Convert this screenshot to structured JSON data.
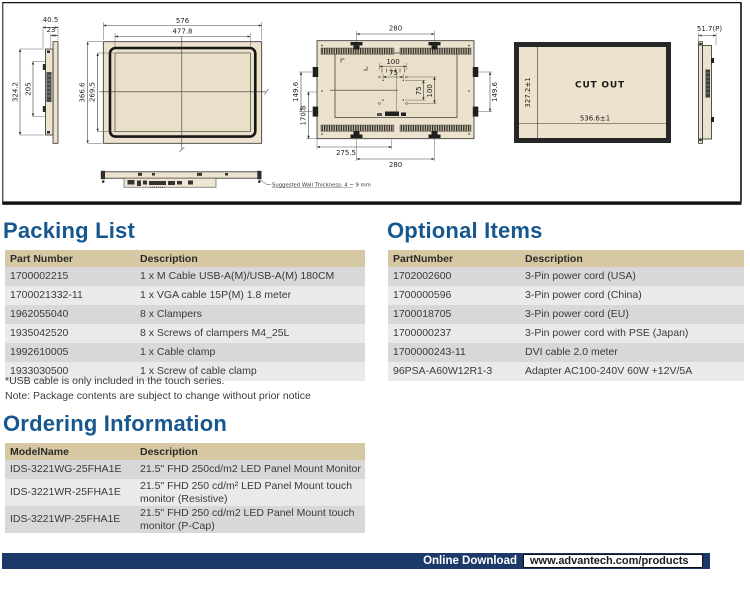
{
  "colors": {
    "heading_blue": "#17578f",
    "table_header_bg": "#d6c8a2",
    "row_dark": "#d8d8d8",
    "row_light": "#eaeaea",
    "footer_bar_navy": "#1b3a69",
    "drawing_fill_tan": "#ece2cd"
  },
  "drawings": {
    "side_left": {
      "depth": "40.5",
      "depth_inner": "23",
      "height": "324.2",
      "height_inner": "205"
    },
    "front": {
      "width": "576",
      "width_inner": "477.8",
      "height": "366.6",
      "height_inner": "269.5"
    },
    "bottom": {
      "note": "Suggested Wall Thickness: 4 ~ 9 mm"
    },
    "back": {
      "width_top": "280",
      "vesa_h100": "100",
      "vesa_h75": "75",
      "vesa_v75": "75",
      "vesa_v100": "100",
      "clamp_left": "149.6",
      "clamp_right": "149.6",
      "height_bottom_left": "170.8",
      "width_bottom_inner": "275.5",
      "width_bottom": "280"
    },
    "cutout": {
      "label": "CUT OUT",
      "width": "536.6±1",
      "height": "327.2±1"
    },
    "side_right": {
      "depth": "51.7(P)"
    }
  },
  "packing_list": {
    "title": "Packing List",
    "columns": [
      "Part Number",
      "Description"
    ],
    "rows": [
      {
        "part": "1700002215",
        "desc": "1 x M Cable USB-A(M)/USB-A(M) 180CM"
      },
      {
        "part": "1700021332-11",
        "desc": "1 x VGA cable 15P(M) 1.8 meter"
      },
      {
        "part": "1962055040",
        "desc": "8 x Clampers"
      },
      {
        "part": "1935042520",
        "desc": "8 x Screws of clampers M4_25L"
      },
      {
        "part": "1992610005",
        "desc": "1 x Cable clamp"
      },
      {
        "part": "1933030500",
        "desc": "1 x Screw of cable clamp"
      }
    ],
    "notes": [
      "*USB cable is only included in the touch series.",
      "Note: Package contents are subject to change without prior notice"
    ]
  },
  "optional_items": {
    "title": "Optional Items",
    "columns": [
      "PartNumber",
      "Description"
    ],
    "rows": [
      {
        "part": "1702002600",
        "desc": "3-Pin power cord (USA)"
      },
      {
        "part": "1700000596",
        "desc": "3-Pin power cord (China)"
      },
      {
        "part": "1700018705",
        "desc": "3-Pin power cord (EU)"
      },
      {
        "part": "1700000237",
        "desc": "3-Pin power cord with PSE (Japan)"
      },
      {
        "part": "1700000243-11",
        "desc": "DVI cable 2.0 meter"
      },
      {
        "part": "96PSA-A60W12R1-3",
        "desc": "Adapter AC100-240V 60W +12V/5A"
      }
    ]
  },
  "ordering_information": {
    "title": "Ordering Information",
    "columns": [
      "ModelName",
      "Description"
    ],
    "rows": [
      {
        "model": "IDS-3221WG-25FHA1E",
        "desc": "21.5\" FHD 250cd/m2 LED Panel Mount Monitor"
      },
      {
        "model": "IDS-3221WR-25FHA1E",
        "desc": "21.5\" FHD 250 cd/m² LED Panel Mount touch monitor (Resistive)"
      },
      {
        "model": "IDS-3221WP-25FHA1E",
        "desc": "21.5\" FHD 250 cd/m2 LED Panel Mount touch monitor (P-Cap)"
      }
    ]
  },
  "footer": {
    "label": "Online Download",
    "url": "www.advantech.com/products"
  }
}
